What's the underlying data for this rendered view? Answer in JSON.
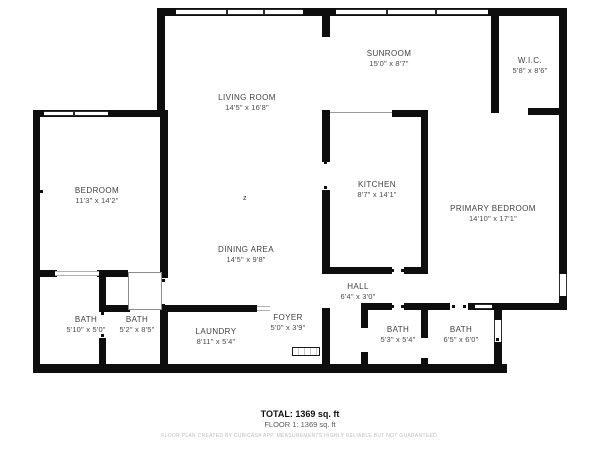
{
  "plan": {
    "rooms": {
      "living_room": {
        "name": "LIVING ROOM",
        "dims": "14'5\" x 16'8\""
      },
      "sunroom": {
        "name": "SUNROOM",
        "dims": "15'0\" x 8'7\""
      },
      "wic": {
        "name": "W.I.C.",
        "dims": "5'8\" x 8'6\""
      },
      "bedroom": {
        "name": "BEDROOM",
        "dims": "11'3\" x 14'2\""
      },
      "kitchen": {
        "name": "KITCHEN",
        "dims": "8'7\" x 14'1\""
      },
      "primary_bedroom": {
        "name": "PRIMARY BEDROOM",
        "dims": "14'10\" x 17'1\""
      },
      "dining_area": {
        "name": "DINING AREA",
        "dims": "14'5\" x 9'8\""
      },
      "hall": {
        "name": "HALL",
        "dims": "6'4\" x 3'0\""
      },
      "bath_1": {
        "name": "BATH",
        "dims": "5'10\" x 5'0\""
      },
      "bath_2": {
        "name": "BATH",
        "dims": "5'2\" x 8'5\""
      },
      "laundry": {
        "name": "LAUNDRY",
        "dims": "8'11\" x 5'4\""
      },
      "foyer": {
        "name": "FOYER",
        "dims": "5'0\" x 3'9\""
      },
      "bath_3": {
        "name": "BATH",
        "dims": "5'3\" x 5'4\""
      },
      "bath_4": {
        "name": "BATH",
        "dims": "6'5\" x 6'0\""
      }
    },
    "summary": {
      "total": "TOTAL: 1369 sq. ft",
      "floor": "FLOOR 1: 1369 sq. ft"
    },
    "disclaimer": "FLOOR PLAN CREATED BY CUBICASA APP. MEASUREMENTS HIGHLY RELIABLE BUT NOT GUARANTEED.",
    "marker": "z",
    "colors": {
      "wall": "#0e0e0e",
      "room_label": "#3f3f3f",
      "dims_label": "#4a4a4a",
      "summary_total": "#111111",
      "summary_floor": "#5a5a5a",
      "disclaimer": "#bdbdbd"
    }
  }
}
